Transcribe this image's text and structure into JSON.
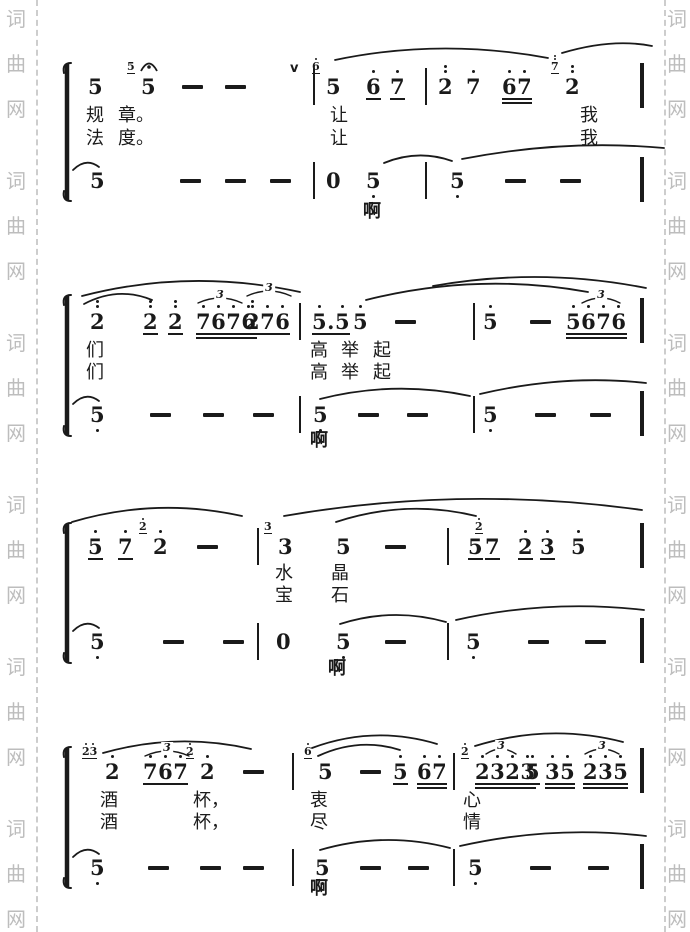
{
  "page": {
    "width": 690,
    "height": 932,
    "paper_color": "#ffffff",
    "ink_color": "#1a1a1a"
  },
  "watermark": {
    "chars": [
      "词",
      "曲",
      "网"
    ],
    "color": "#bdbdbd",
    "columns": [
      {
        "x": 6
      },
      {
        "x": 667
      }
    ],
    "group_starts": [
      8,
      170,
      332,
      494,
      656,
      818
    ],
    "char_step": 45,
    "dash_lines": [
      {
        "x": 36
      },
      {
        "x": 664
      }
    ]
  },
  "score": {
    "systems": [
      {
        "melody_y": 75,
        "lyric1_y": 105,
        "lyric2_y": 128,
        "bass_y": 169,
        "bracket": {
          "x": 62,
          "y1": 63,
          "y2": 201
        },
        "ah": {
          "x": 363,
          "y": 201,
          "t": "啊"
        },
        "melody": [
          {
            "x": 88,
            "d": "5"
          },
          {
            "x": 141,
            "d": "5",
            "fermata": true,
            "grace": {
              "d": "5",
              "u": 1
            }
          },
          {
            "x": 182,
            "dash": true
          },
          {
            "x": 225,
            "dash": true
          },
          {
            "x": 326,
            "d": "5",
            "grace": {
              "d": "6",
              "da": "1",
              "u": 1
            }
          },
          {
            "x": 366,
            "d": "6",
            "da": "1",
            "u": 1
          },
          {
            "x": 390,
            "d": "7",
            "da": "1",
            "u": 1
          },
          {
            "x": 438,
            "d": "2",
            "da": "2"
          },
          {
            "x": 466,
            "d": "7",
            "da": "1"
          },
          {
            "x": 502,
            "d": "67",
            "da": "11",
            "u": 2
          },
          {
            "x": 565,
            "d": "2",
            "da": "2",
            "grace": {
              "d": "7",
              "da": "2",
              "u": 1
            }
          }
        ],
        "bass": [
          {
            "x": 90,
            "d": "5"
          },
          {
            "x": 180,
            "dash": true
          },
          {
            "x": 225,
            "dash": true
          },
          {
            "x": 270,
            "dash": true
          },
          {
            "x": 326,
            "d": "0"
          },
          {
            "x": 366,
            "d": "5",
            "db": "1"
          },
          {
            "x": 450,
            "d": "5",
            "db": "1"
          },
          {
            "x": 505,
            "dash": true
          },
          {
            "x": 560,
            "dash": true
          }
        ],
        "lyrics1": [
          {
            "x": 86,
            "t": "规"
          },
          {
            "x": 118,
            "t": "章。"
          },
          {
            "x": 330,
            "t": "让"
          },
          {
            "x": 580,
            "t": "我"
          }
        ],
        "lyrics2": [
          {
            "x": 86,
            "t": "法"
          },
          {
            "x": 118,
            "t": "度。"
          },
          {
            "x": 330,
            "t": "让"
          },
          {
            "x": 580,
            "t": "我"
          }
        ],
        "barlines": [
          {
            "x": 313,
            "row": "m"
          },
          {
            "x": 313,
            "row": "b"
          },
          {
            "x": 425,
            "row": "m"
          },
          {
            "x": 425,
            "row": "b"
          },
          {
            "x": 640,
            "row": "m",
            "end": true
          },
          {
            "x": 640,
            "row": "b",
            "end": true
          }
        ],
        "slurs": [
          {
            "x1": 335,
            "y1": 60,
            "cx": 440,
            "cy": 38,
            "x2": 548,
            "y2": 58
          },
          {
            "x1": 562,
            "y1": 53,
            "cx": 612,
            "cy": 38,
            "x2": 652,
            "y2": 46
          },
          {
            "x1": 73,
            "y1": 170,
            "cx": 86,
            "cy": 157,
            "x2": 99,
            "y2": 167
          },
          {
            "x1": 384,
            "y1": 163,
            "cx": 418,
            "cy": 149,
            "x2": 452,
            "y2": 161
          },
          {
            "x1": 462,
            "y1": 159,
            "cx": 565,
            "cy": 139,
            "x2": 664,
            "y2": 148
          }
        ],
        "triplets": [],
        "marks": [
          {
            "x": 290,
            "y": 61,
            "t": "v"
          }
        ]
      },
      {
        "melody_y": 310,
        "lyric1_y": 340,
        "lyric2_y": 362,
        "bass_y": 403,
        "bracket": {
          "x": 62,
          "y1": 295,
          "y2": 436
        },
        "ah": {
          "x": 310,
          "y": 430,
          "t": "啊"
        },
        "melody": [
          {
            "x": 90,
            "d": "2",
            "da": "2"
          },
          {
            "x": 143,
            "d": "2",
            "da": "2",
            "u": 1
          },
          {
            "x": 168,
            "d": "2",
            "da": "2",
            "u": 1
          },
          {
            "x": 196,
            "d": "7676",
            "da": "1111",
            "u": 2
          },
          {
            "x": 245,
            "d": "276",
            "da": "211",
            "u": 1
          },
          {
            "x": 312,
            "d": "5.5",
            "da": "101",
            "u": 1
          },
          {
            "x": 353,
            "d": "5",
            "da": "1"
          },
          {
            "x": 395,
            "dash": true
          },
          {
            "x": 483,
            "d": "5",
            "da": "1"
          },
          {
            "x": 530,
            "dash": true
          },
          {
            "x": 566,
            "d": "5676",
            "da": "1111",
            "u": 2
          }
        ],
        "bass": [
          {
            "x": 90,
            "d": "5",
            "db": "1"
          },
          {
            "x": 150,
            "dash": true
          },
          {
            "x": 203,
            "dash": true
          },
          {
            "x": 253,
            "dash": true
          },
          {
            "x": 313,
            "d": "5",
            "db": "1"
          },
          {
            "x": 358,
            "dash": true
          },
          {
            "x": 407,
            "dash": true
          },
          {
            "x": 483,
            "d": "5",
            "db": "1"
          },
          {
            "x": 535,
            "dash": true
          },
          {
            "x": 590,
            "dash": true
          }
        ],
        "lyrics1": [
          {
            "x": 86,
            "t": "们"
          },
          {
            "x": 310,
            "t": "高"
          },
          {
            "x": 341,
            "t": "举"
          },
          {
            "x": 373,
            "t": "起"
          }
        ],
        "lyrics2": [
          {
            "x": 86,
            "t": "们"
          },
          {
            "x": 310,
            "t": "高"
          },
          {
            "x": 341,
            "t": "举"
          },
          {
            "x": 373,
            "t": "起"
          }
        ],
        "barlines": [
          {
            "x": 299,
            "row": "m"
          },
          {
            "x": 299,
            "row": "b"
          },
          {
            "x": 473,
            "row": "m"
          },
          {
            "x": 473,
            "row": "b"
          },
          {
            "x": 640,
            "row": "m",
            "end": true
          },
          {
            "x": 640,
            "row": "b",
            "end": true
          }
        ],
        "slurs": [
          {
            "x1": 82,
            "y1": 296,
            "cx": 190,
            "cy": 268,
            "x2": 300,
            "y2": 292
          },
          {
            "x1": 84,
            "y1": 304,
            "cx": 118,
            "cy": 286,
            "x2": 152,
            "y2": 300
          },
          {
            "x1": 366,
            "y1": 300,
            "cx": 477,
            "cy": 272,
            "x2": 588,
            "y2": 292
          },
          {
            "x1": 433,
            "y1": 286,
            "cx": 540,
            "cy": 267,
            "x2": 646,
            "y2": 288
          },
          {
            "x1": 73,
            "y1": 404,
            "cx": 86,
            "cy": 391,
            "x2": 99,
            "y2": 401
          },
          {
            "x1": 320,
            "y1": 399,
            "cx": 395,
            "cy": 380,
            "x2": 470,
            "y2": 396
          },
          {
            "x1": 480,
            "y1": 394,
            "cx": 565,
            "cy": 374,
            "x2": 646,
            "y2": 383
          }
        ],
        "triplets": [
          {
            "x1": 198,
            "x2": 242,
            "y": 303,
            "label": "3"
          },
          {
            "x1": 247,
            "x2": 291,
            "y": 296,
            "label": "3"
          },
          {
            "x1": 582,
            "x2": 620,
            "y": 303,
            "label": "3"
          }
        ],
        "marks": []
      },
      {
        "melody_y": 535,
        "lyric1_y": 563,
        "lyric2_y": 585,
        "bass_y": 630,
        "bracket": {
          "x": 62,
          "y1": 523,
          "y2": 663
        },
        "ah": {
          "x": 328,
          "y": 658,
          "t": "啊"
        },
        "melody": [
          {
            "x": 88,
            "d": "5",
            "da": "1",
            "u": 1
          },
          {
            "x": 118,
            "d": "7",
            "da": "1",
            "u": 1
          },
          {
            "x": 153,
            "d": "2",
            "da": "1",
            "grace": {
              "d": "2",
              "da": "1",
              "u": 1
            }
          },
          {
            "x": 197,
            "dash": true
          },
          {
            "x": 278,
            "d": "3",
            "grace": {
              "d": "3",
              "u": 1
            }
          },
          {
            "x": 336,
            "d": "5"
          },
          {
            "x": 385,
            "dash": true
          },
          {
            "x": 468,
            "d": "5",
            "u": 1
          },
          {
            "x": 485,
            "d": "7",
            "u": 1,
            "grace": {
              "d": "2",
              "da": "1",
              "u": 1,
              "gx": -10
            }
          },
          {
            "x": 518,
            "d": "2",
            "da": "1",
            "u": 1
          },
          {
            "x": 540,
            "d": "3",
            "da": "1",
            "u": 1
          },
          {
            "x": 571,
            "d": "5",
            "da": "1"
          }
        ],
        "bass": [
          {
            "x": 90,
            "d": "5",
            "db": "1"
          },
          {
            "x": 163,
            "dash": true
          },
          {
            "x": 223,
            "dash": true
          },
          {
            "x": 276,
            "d": "0"
          },
          {
            "x": 336,
            "d": "5",
            "db": "1"
          },
          {
            "x": 385,
            "dash": true
          },
          {
            "x": 466,
            "d": "5",
            "db": "1"
          },
          {
            "x": 528,
            "dash": true
          },
          {
            "x": 585,
            "dash": true
          }
        ],
        "lyrics1": [
          {
            "x": 275,
            "t": "水"
          },
          {
            "x": 331,
            "t": "晶"
          }
        ],
        "lyrics2": [
          {
            "x": 275,
            "t": "宝"
          },
          {
            "x": 331,
            "t": "石"
          }
        ],
        "barlines": [
          {
            "x": 257,
            "row": "m"
          },
          {
            "x": 257,
            "row": "b"
          },
          {
            "x": 447,
            "row": "m"
          },
          {
            "x": 447,
            "row": "b"
          },
          {
            "x": 640,
            "row": "m",
            "end": true
          },
          {
            "x": 640,
            "row": "b",
            "end": true
          }
        ],
        "slurs": [
          {
            "x1": 72,
            "y1": 522,
            "cx": 156,
            "cy": 497,
            "x2": 242,
            "y2": 516
          },
          {
            "x1": 284,
            "y1": 516,
            "cx": 462,
            "cy": 485,
            "x2": 642,
            "y2": 510
          },
          {
            "x1": 336,
            "y1": 522,
            "cx": 406,
            "cy": 499,
            "x2": 476,
            "y2": 516
          },
          {
            "x1": 73,
            "y1": 631,
            "cx": 86,
            "cy": 618,
            "x2": 99,
            "y2": 628
          },
          {
            "x1": 340,
            "y1": 624,
            "cx": 393,
            "cy": 607,
            "x2": 446,
            "y2": 622
          },
          {
            "x1": 456,
            "y1": 620,
            "cx": 549,
            "cy": 599,
            "x2": 644,
            "y2": 610
          }
        ],
        "triplets": [],
        "marks": []
      },
      {
        "melody_y": 760,
        "lyric1_y": 790,
        "lyric2_y": 812,
        "bass_y": 856,
        "bracket": {
          "x": 62,
          "y1": 747,
          "y2": 888
        },
        "ah": {
          "x": 310,
          "y": 878,
          "t": "啊"
        },
        "melody": [
          {
            "x": 105,
            "d": "2",
            "da": "1",
            "grace": {
              "d": "23",
              "da": "11",
              "u": 1
            }
          },
          {
            "x": 143,
            "d": "767",
            "da": "111",
            "u": 1
          },
          {
            "x": 200,
            "d": "2",
            "da": "1",
            "grace": {
              "d": "2",
              "da": "1",
              "u": 1
            }
          },
          {
            "x": 243,
            "dash": true
          },
          {
            "x": 318,
            "d": "5",
            "grace": {
              "d": "6",
              "da": "1",
              "u": 1
            }
          },
          {
            "x": 360,
            "dash": true
          },
          {
            "x": 393,
            "d": "5",
            "da": "1",
            "u": 1
          },
          {
            "x": 417,
            "d": "67",
            "da": "11",
            "u": 2
          },
          {
            "x": 475,
            "d": "2323",
            "da": "1111",
            "u": 2,
            "grace": {
              "d": "2",
              "da": "1",
              "u": 1
            }
          },
          {
            "x": 525,
            "d": "5",
            "da": "1",
            "u": 1
          },
          {
            "x": 545,
            "d": "35",
            "da": "11",
            "u": 2
          },
          {
            "x": 583,
            "d": "235",
            "da": "111",
            "u": 2
          }
        ],
        "bass": [
          {
            "x": 90,
            "d": "5",
            "db": "1"
          },
          {
            "x": 148,
            "dash": true
          },
          {
            "x": 200,
            "dash": true
          },
          {
            "x": 243,
            "dash": true
          },
          {
            "x": 315,
            "d": "5",
            "db": "1"
          },
          {
            "x": 360,
            "dash": true
          },
          {
            "x": 408,
            "dash": true
          },
          {
            "x": 468,
            "d": "5",
            "db": "1"
          },
          {
            "x": 530,
            "dash": true
          },
          {
            "x": 588,
            "dash": true
          }
        ],
        "lyrics1": [
          {
            "x": 100,
            "t": "酒"
          },
          {
            "x": 193,
            "t": "杯，"
          },
          {
            "x": 310,
            "t": "衷"
          },
          {
            "x": 463,
            "t": "心"
          }
        ],
        "lyrics2": [
          {
            "x": 100,
            "t": "酒"
          },
          {
            "x": 193,
            "t": "杯，"
          },
          {
            "x": 310,
            "t": "尽"
          },
          {
            "x": 463,
            "t": "情"
          }
        ],
        "barlines": [
          {
            "x": 292,
            "row": "m"
          },
          {
            "x": 292,
            "row": "b"
          },
          {
            "x": 453,
            "row": "m"
          },
          {
            "x": 453,
            "row": "b"
          },
          {
            "x": 640,
            "row": "m",
            "end": true
          },
          {
            "x": 640,
            "row": "b",
            "end": true
          }
        ],
        "slurs": [
          {
            "x1": 103,
            "y1": 753,
            "cx": 177,
            "cy": 732,
            "x2": 251,
            "y2": 749
          },
          {
            "x1": 312,
            "y1": 748,
            "cx": 374,
            "cy": 725,
            "x2": 437,
            "y2": 744
          },
          {
            "x1": 318,
            "y1": 756,
            "cx": 359,
            "cy": 737,
            "x2": 400,
            "y2": 750
          },
          {
            "x1": 475,
            "y1": 746,
            "cx": 549,
            "cy": 723,
            "x2": 623,
            "y2": 742
          },
          {
            "x1": 73,
            "y1": 857,
            "cx": 86,
            "cy": 844,
            "x2": 99,
            "y2": 854
          },
          {
            "x1": 320,
            "y1": 850,
            "cx": 385,
            "cy": 831,
            "x2": 450,
            "y2": 848
          },
          {
            "x1": 460,
            "y1": 846,
            "cx": 553,
            "cy": 825,
            "x2": 646,
            "y2": 836
          }
        ],
        "triplets": [
          {
            "x1": 145,
            "x2": 189,
            "y": 756,
            "label": "3"
          },
          {
            "x1": 486,
            "x2": 516,
            "y": 754,
            "label": "3"
          },
          {
            "x1": 585,
            "x2": 619,
            "y": 754,
            "label": "3"
          }
        ],
        "marks": []
      }
    ]
  }
}
